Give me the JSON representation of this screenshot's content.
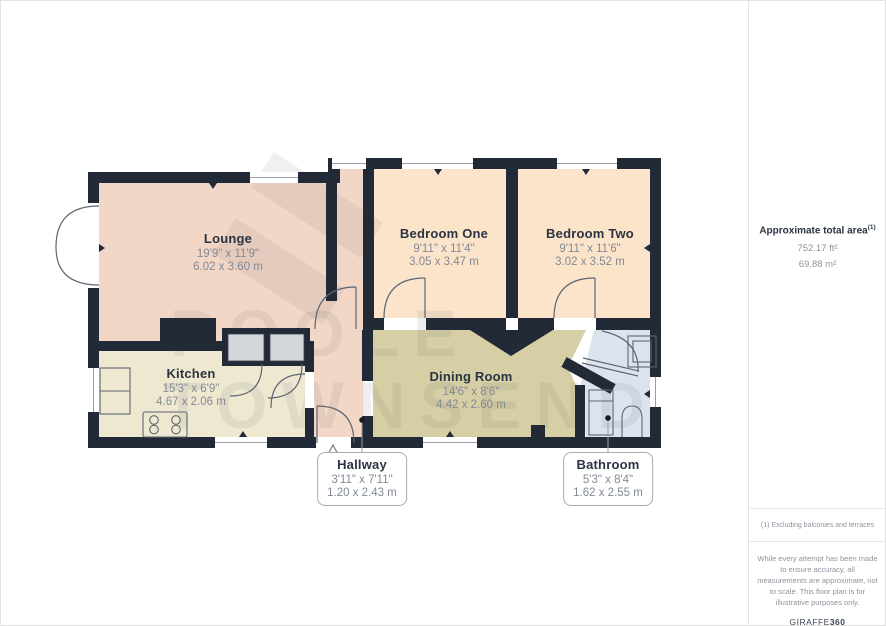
{
  "floor_plan": {
    "watermark": {
      "line1": "POOLE",
      "line2": "TOWNSEND"
    },
    "rooms": [
      {
        "name": "Lounge",
        "imperial": "19'9\" x 11'9\"",
        "metric": "6.02 x 3.60 m",
        "fill": "#f2d6c6"
      },
      {
        "name": "Bedroom One",
        "imperial": "9'11\" x 11'4\"",
        "metric": "3.05 x 3.47 m",
        "fill": "#fbe4ca"
      },
      {
        "name": "Bedroom Two",
        "imperial": "9'11\" x 11'6\"",
        "metric": "3.02 x 3.52 m",
        "fill": "#fbe4ca"
      },
      {
        "name": "Kitchen",
        "imperial": "15'3\" x 6'9\"",
        "metric": "4.67 x 2.06 m",
        "fill": "#efe8d1"
      },
      {
        "name": "Dining Room",
        "imperial": "14'6\" x 8'6\"",
        "metric": "4.42 x 2.60 m",
        "fill": "#d6cea4"
      },
      {
        "name": "Hallway",
        "imperial": "3'11\" x 7'11\"",
        "metric": "1.20 x 2.43 m",
        "fill": "#f2d6c6"
      },
      {
        "name": "Bathroom",
        "imperial": "5'3\" x 8'4\"",
        "metric": "1.62 x 2.55 m",
        "fill": "#dde3ed"
      }
    ],
    "colors": {
      "wall": "#222a37",
      "door_line": "#5c6672",
      "window_line": "#97a0aa",
      "cupboard": "#d3d7db",
      "room_name_text": "#2b3442",
      "dimension_text": "#828a96"
    }
  },
  "sidebar": {
    "total_area_label": "Approximate total area",
    "total_area_superscript": "(1)",
    "area_ft": "752.17 ft²",
    "area_m": "69.88 m²",
    "footnote": "(1) Excluding balconies and terraces",
    "disclaimer": "While every attempt has been made to ensure accuracy, all measurements are approximate, not to scale. This floor plan is for illustrative purposes only.",
    "brand_name": "GIRAFFE",
    "brand_suffix": "360"
  }
}
